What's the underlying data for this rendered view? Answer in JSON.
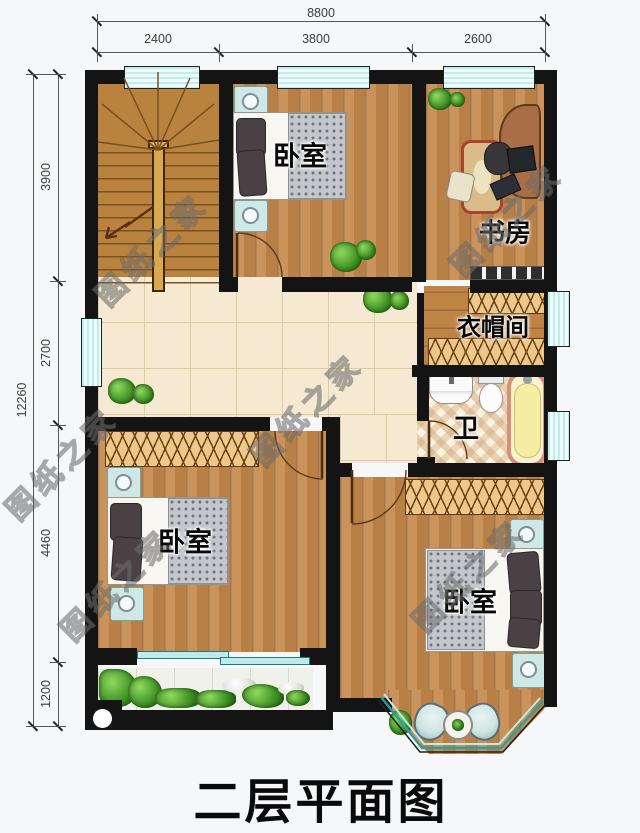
{
  "title": "二层平面图",
  "watermark": {
    "text": "图纸之家"
  },
  "rooms": {
    "bedroom_top": "卧室",
    "study": "书房",
    "cloakroom": "衣帽间",
    "bathroom": "卫",
    "bedroom_left": "卧室",
    "bedroom_right": "卧室"
  },
  "dimensions": {
    "top": {
      "total": "8800",
      "segments": [
        "2400",
        "3800",
        "2600"
      ]
    },
    "left": {
      "total": "12260",
      "segments": [
        "3900",
        "2700",
        "4460",
        "1200"
      ]
    }
  },
  "colors": {
    "wall": "#141414",
    "wood_floor": "#c4874a",
    "hall_tile": "#f5e9d2",
    "bath_tile": "#fbf3e2",
    "window_glass": "#bfecec",
    "window_line": "#1d7d7d",
    "wardrobe": "#ecc88b",
    "bed_sheet": "#f8f6f1",
    "pillow": "#4a4144",
    "blanket": "#c3c7cc",
    "nightstand": "#cfe8e5",
    "bathtub_rim": "#d4907a",
    "bathtub_fill": "#fbf3cf",
    "plant_green": "#3f8f23",
    "stair_wood": "#b9823f",
    "watermark_gray": "#5f5f5f",
    "dimension_text": "#3c3c3c",
    "title_color": "#0a0a0a"
  }
}
